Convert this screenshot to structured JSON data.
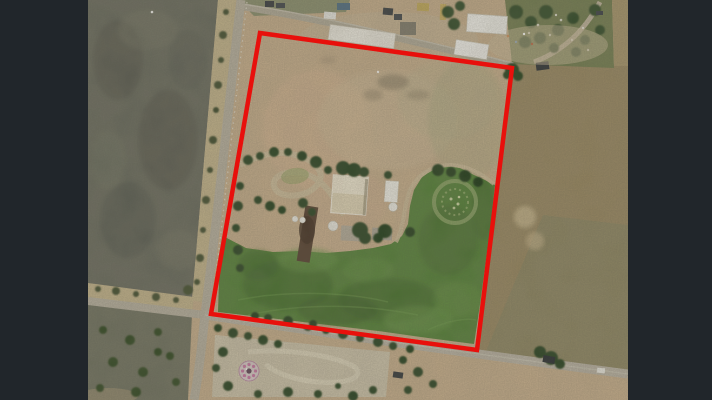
{
  "scene": {
    "description": "Aerial satellite photograph of a rural farm property outlined with a red boundary line, letterboxed on a dark background",
    "boundary": {
      "color": "#e8100c",
      "stroke_width": 4.5,
      "points": [
        [
          172,
          33
        ],
        [
          424,
          68
        ],
        [
          389,
          350
        ],
        [
          123,
          314
        ]
      ]
    },
    "palette": {
      "letterbox": "#21262b",
      "boundary": "#e8100c",
      "dirt": "#c3aa88",
      "paddock": "#4f7c33",
      "fieldLeft": "#64665a",
      "fieldRight": "#94835d",
      "road": "#b3ac9c",
      "tree": "#243e1b",
      "building": "#ece9e0",
      "marker": "#c4739f"
    }
  }
}
